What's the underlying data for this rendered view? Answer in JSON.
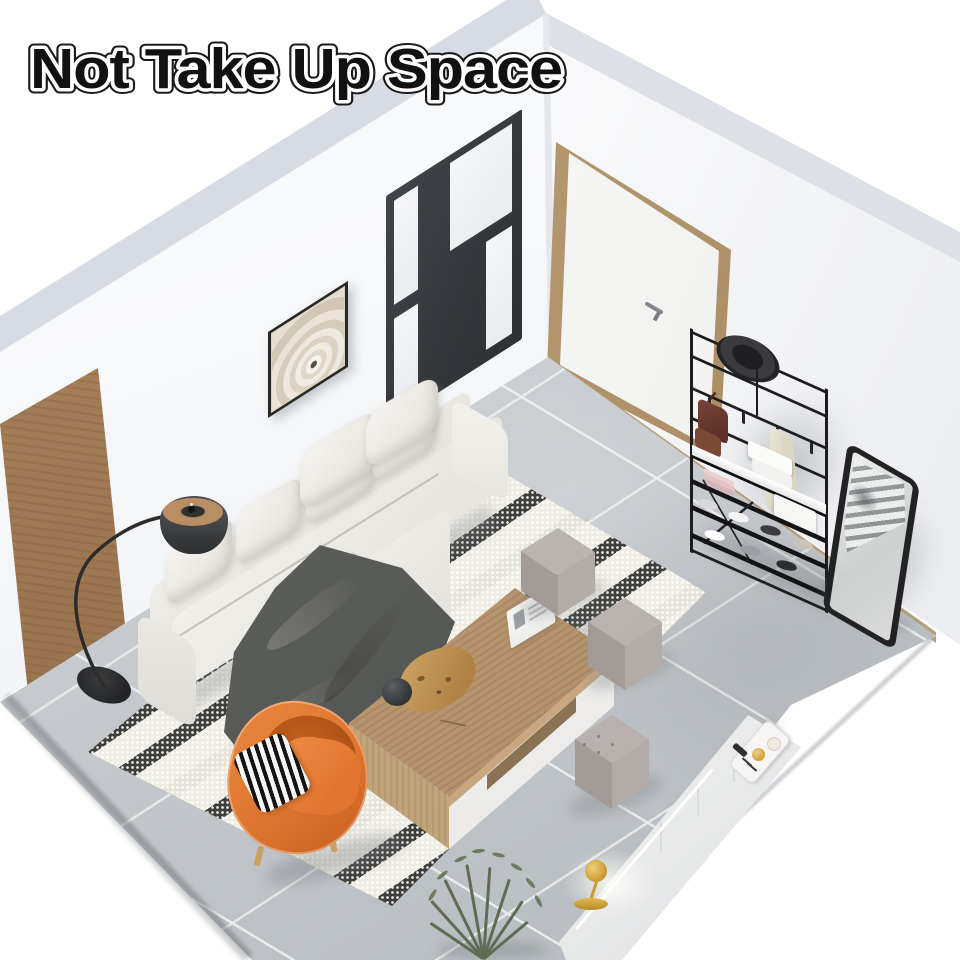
{
  "title": {
    "text": "Not Take Up Space"
  },
  "colors": {
    "wall": "#f8f9fb",
    "band": "#d7dbe3",
    "floor": "#c7cbcf",
    "rug-ivory": "#efece3",
    "throw": "#5a5c59",
    "accent-orange": "#df752e",
    "wood": "#b2906a",
    "metal-black": "#1d1d1f",
    "gold": "#d4a43c",
    "plant": "#5f6b52",
    "title-fill": "#111111",
    "title-outline": "#ffffff"
  },
  "scene": {
    "style": "isometric 3D living-room product render",
    "furniture": [
      {
        "name": "coat-rack-shoe-bench",
        "color": "black metal",
        "holds": "hat, handbag, scarf, storage boxes, towels, shoes"
      },
      {
        "name": "full-length-mirror",
        "color": "black frame"
      },
      {
        "name": "sectional-sofa",
        "color": "off-white",
        "accessories": "white cushions, dark grey throw blanket"
      },
      {
        "name": "arc-floor-lamp",
        "color": "black with tan rim"
      },
      {
        "name": "coffee-table",
        "color": "oak top, white drawers",
        "decor": "open book, driftwood, black sphere"
      },
      {
        "name": "ottoman-cubes",
        "count": 3,
        "color": "grey"
      },
      {
        "name": "accent-armchair",
        "color": "orange",
        "pillow": "black-white chevron"
      },
      {
        "name": "area-rug",
        "color": "ivory with black speckled stripes"
      },
      {
        "name": "interior-door",
        "color": "white with oak frame"
      },
      {
        "name": "glass-partition",
        "color": "black steel frame"
      },
      {
        "name": "wall-art",
        "subject": "arched corridor print"
      },
      {
        "name": "tv-console",
        "color": "white",
        "decor": "gold table lamp, serving tray"
      },
      {
        "name": "floor-plant",
        "color": "green"
      }
    ]
  }
}
